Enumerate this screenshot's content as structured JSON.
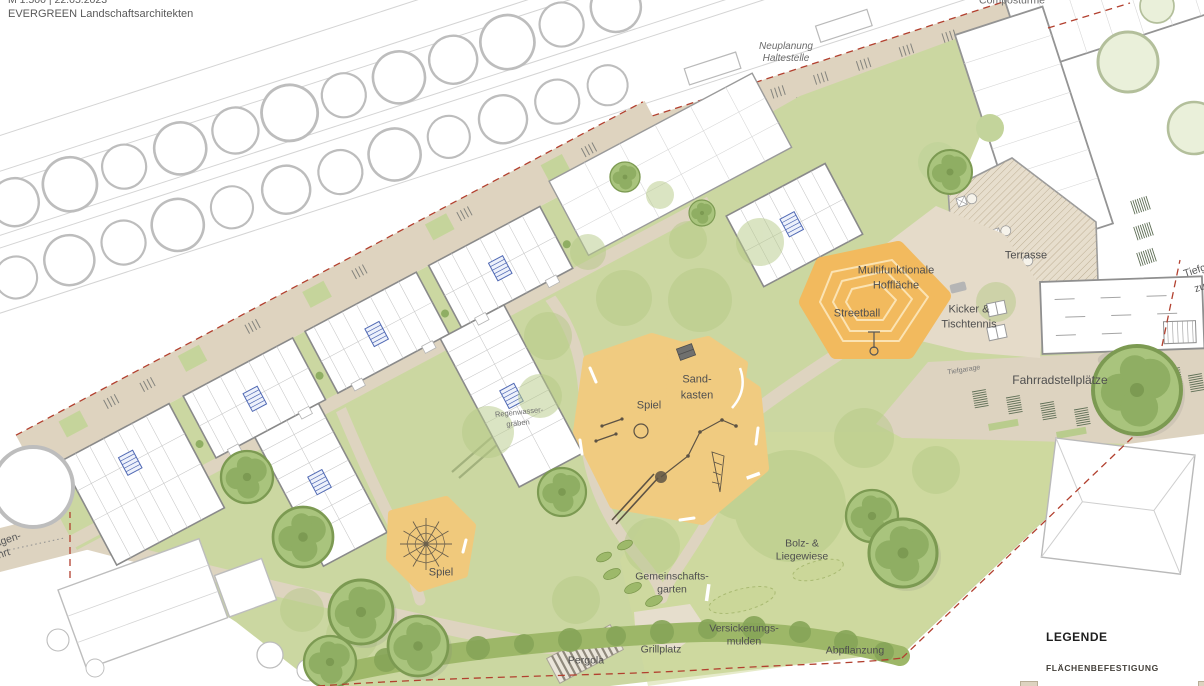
{
  "meta": {
    "scale_date": "M 1:500 | 22.05.2023",
    "firm": "EVERGREEN Landschaftsarchitekten"
  },
  "plan_labels": {
    "neuplanung_1": "Neuplanung",
    "neuplanung_2": "Haltestelle",
    "compost": "Compostürme",
    "tiefgarage_zufahrt_1": "Tiefg",
    "tiefgarage_zufahrt_2": "zu",
    "multifunktionale_1": "Multifunktionale",
    "multifunktionale_2": "Hoffläche",
    "streetball": "Streetball",
    "terrasse": "Terrasse",
    "kicker_1": "Kicker &",
    "kicker_2": "Tischtennis",
    "tiefgarage_klein": "Tiefgarage",
    "fahrradstellplaetze": "Fahrradstellplätze",
    "sandkasten_1": "Sand-",
    "sandkasten_2": "kasten",
    "spiel_mitte": "Spiel",
    "regenwasser_1": "Regenwasser-",
    "regenwasser_2": "gräben",
    "spiel_links": "Spiel",
    "gemeinschaftsgarten_1": "Gemeinschafts-",
    "gemeinschaftsgarten_2": "garten",
    "bolz_1": "Bolz- &",
    "bolz_2": "Liegewiese",
    "versickerung_1": "Versickerungs-",
    "versickerung_2": "mulden",
    "abpflanzung": "Abpflanzung",
    "grillplatz": "Grillplatz",
    "pergola": "Pergola",
    "zufahrt_links_1": "agen-",
    "zufahrt_links_2": "hrt"
  },
  "legend": {
    "title": "LEGENDE",
    "section_1": "FLÄCHENBEFESTIGUNG"
  },
  "colors": {
    "lawn": "#cbd7a1",
    "path_beige": "#ded4c0",
    "plaza_beige": "#e5dbc9",
    "play_sand": "#f0cb80",
    "streetball_orange": "#f2ba5e",
    "hedge_green": "#9db768",
    "tree_green": "#a9c47d",
    "boundary_red": "#b2402f",
    "wall_gray": "#8a8a8a",
    "stair_blue": "#5069b4"
  }
}
